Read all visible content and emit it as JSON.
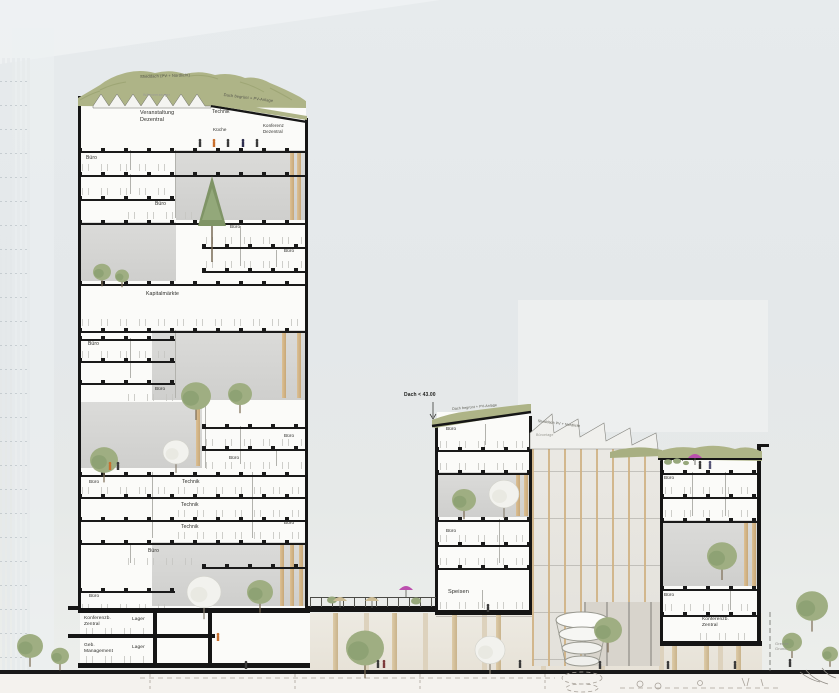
{
  "drawing": {
    "kind": "architectural-cross-section",
    "height_note": "Dach < 43.00"
  },
  "colors": {
    "sky": "#e5e9eb",
    "roof_green": "#aeb487",
    "wood": "#d6b488",
    "section_black": "#161616",
    "tree_green": "#9aab81",
    "blossom_tree": "#f1f1ec",
    "umbrella_pink": "#bb4fae",
    "person_orange": "#c96f2d",
    "ground_paving": "#efece6"
  },
  "labels": [
    {
      "name": "roof-label-sheddach-left",
      "text": "Sheddach (PV + Nordlicht)",
      "x": 140,
      "y": 74,
      "fs": 4,
      "rot": -2,
      "color": "#55554c"
    },
    {
      "name": "roof-label-begruent-left",
      "text": "Dach begrünt + PV-Anlage",
      "x": 224,
      "y": 92,
      "fs": 4,
      "rot": 7,
      "color": "#55554c"
    },
    {
      "name": "attic-note",
      "text": "Wärmeerzeuger",
      "x": 143,
      "y": 93,
      "fs": 3.6,
      "color": "#9a9a94"
    },
    {
      "name": "room-veranstaltung-dezentral",
      "text": "Veranstaltung\nDezentral",
      "x": 140,
      "y": 110,
      "fs": 5.4
    },
    {
      "name": "room-technik-top",
      "text": "Technik",
      "x": 212,
      "y": 109,
      "fs": 5
    },
    {
      "name": "room-kueche",
      "text": "Küche",
      "x": 213,
      "y": 127,
      "fs": 4.6
    },
    {
      "name": "room-konferenz-dezentral",
      "text": "Konferenz\nDezentral",
      "x": 263,
      "y": 123,
      "fs": 4.4
    },
    {
      "name": "room-buero-1",
      "text": "Büro",
      "x": 86,
      "y": 155,
      "fs": 5
    },
    {
      "name": "room-buero-2",
      "text": "Büro",
      "x": 155,
      "y": 201,
      "fs": 5
    },
    {
      "name": "room-buero-3",
      "text": "Büro",
      "x": 230,
      "y": 224,
      "fs": 4.6
    },
    {
      "name": "room-buero-4",
      "text": "Büro",
      "x": 284,
      "y": 248,
      "fs": 4.6
    },
    {
      "name": "room-kapitalmaerkte",
      "text": "Kapitalmärkte",
      "x": 146,
      "y": 291,
      "fs": 5.2
    },
    {
      "name": "room-buero-5",
      "text": "Büro",
      "x": 88,
      "y": 341,
      "fs": 5
    },
    {
      "name": "room-buero-6",
      "text": "Büro",
      "x": 155,
      "y": 386,
      "fs": 4.6
    },
    {
      "name": "room-buero-7",
      "text": "Büro",
      "x": 284,
      "y": 433,
      "fs": 4.6
    },
    {
      "name": "room-buero-8",
      "text": "Büro",
      "x": 229,
      "y": 455,
      "fs": 4.6
    },
    {
      "name": "room-buero-9",
      "text": "Büro",
      "x": 89,
      "y": 479,
      "fs": 4.6
    },
    {
      "name": "room-technik-1",
      "text": "Technik",
      "x": 182,
      "y": 479,
      "fs": 5
    },
    {
      "name": "room-technik-2",
      "text": "Technik",
      "x": 181,
      "y": 502,
      "fs": 5
    },
    {
      "name": "room-technik-3",
      "text": "Technik",
      "x": 181,
      "y": 524,
      "fs": 5
    },
    {
      "name": "room-buero-10",
      "text": "Büro",
      "x": 284,
      "y": 520,
      "fs": 4.6
    },
    {
      "name": "room-buero-11",
      "text": "Büro",
      "x": 148,
      "y": 548,
      "fs": 5
    },
    {
      "name": "room-buero-12",
      "text": "Büro",
      "x": 89,
      "y": 593,
      "fs": 4.6
    },
    {
      "name": "room-konferenzb-zentral-left",
      "text": "Konferenzb.\nZentral",
      "x": 84,
      "y": 616,
      "fs": 4.8
    },
    {
      "name": "room-lager-1",
      "text": "Lager",
      "x": 132,
      "y": 617,
      "fs": 4.8
    },
    {
      "name": "room-geb-management",
      "text": "Geb.\nManagement",
      "x": 84,
      "y": 643,
      "fs": 4.8
    },
    {
      "name": "room-lager-2",
      "text": "Lager",
      "x": 132,
      "y": 645,
      "fs": 4.8
    },
    {
      "name": "annotation-dach-hoehe",
      "text": "Dach < 43.00",
      "x": 404,
      "y": 392,
      "fs": 5,
      "bold": true,
      "color": "#1e1e1c"
    },
    {
      "name": "roof-label-begruent-right",
      "text": "Dach begrünt + PV-Anlage",
      "x": 452,
      "y": 407,
      "fs": 3.6,
      "rot": -5,
      "color": "#55554c"
    },
    {
      "name": "roof-label-sheddach-right",
      "text": "Sheddach PV + Nordlicht",
      "x": 538,
      "y": 419,
      "fs": 3.6,
      "rot": 7,
      "color": "#55554c"
    },
    {
      "name": "facade-note",
      "text": "Büroetage",
      "x": 536,
      "y": 433,
      "fs": 3.6,
      "color": "#9a9a94"
    },
    {
      "name": "room-buero-13",
      "text": "Büro",
      "x": 446,
      "y": 426,
      "fs": 4.6
    },
    {
      "name": "room-buero-14",
      "text": "Büro",
      "x": 446,
      "y": 528,
      "fs": 4.6
    },
    {
      "name": "room-speisen",
      "text": "Speisen",
      "x": 448,
      "y": 589,
      "fs": 5.6
    },
    {
      "name": "room-buero-15",
      "text": "Büro",
      "x": 664,
      "y": 475,
      "fs": 4.6
    },
    {
      "name": "room-buero-16",
      "text": "Büro",
      "x": 664,
      "y": 592,
      "fs": 4.6
    },
    {
      "name": "room-konferenzb-zentral-right",
      "text": "Konferenzb.\nZentral",
      "x": 702,
      "y": 617,
      "fs": 4.8
    },
    {
      "name": "annotation-grenze",
      "text": "Grenze\nGrund.",
      "x": 775,
      "y": 641,
      "fs": 4,
      "color": "#8e8e88"
    }
  ]
}
